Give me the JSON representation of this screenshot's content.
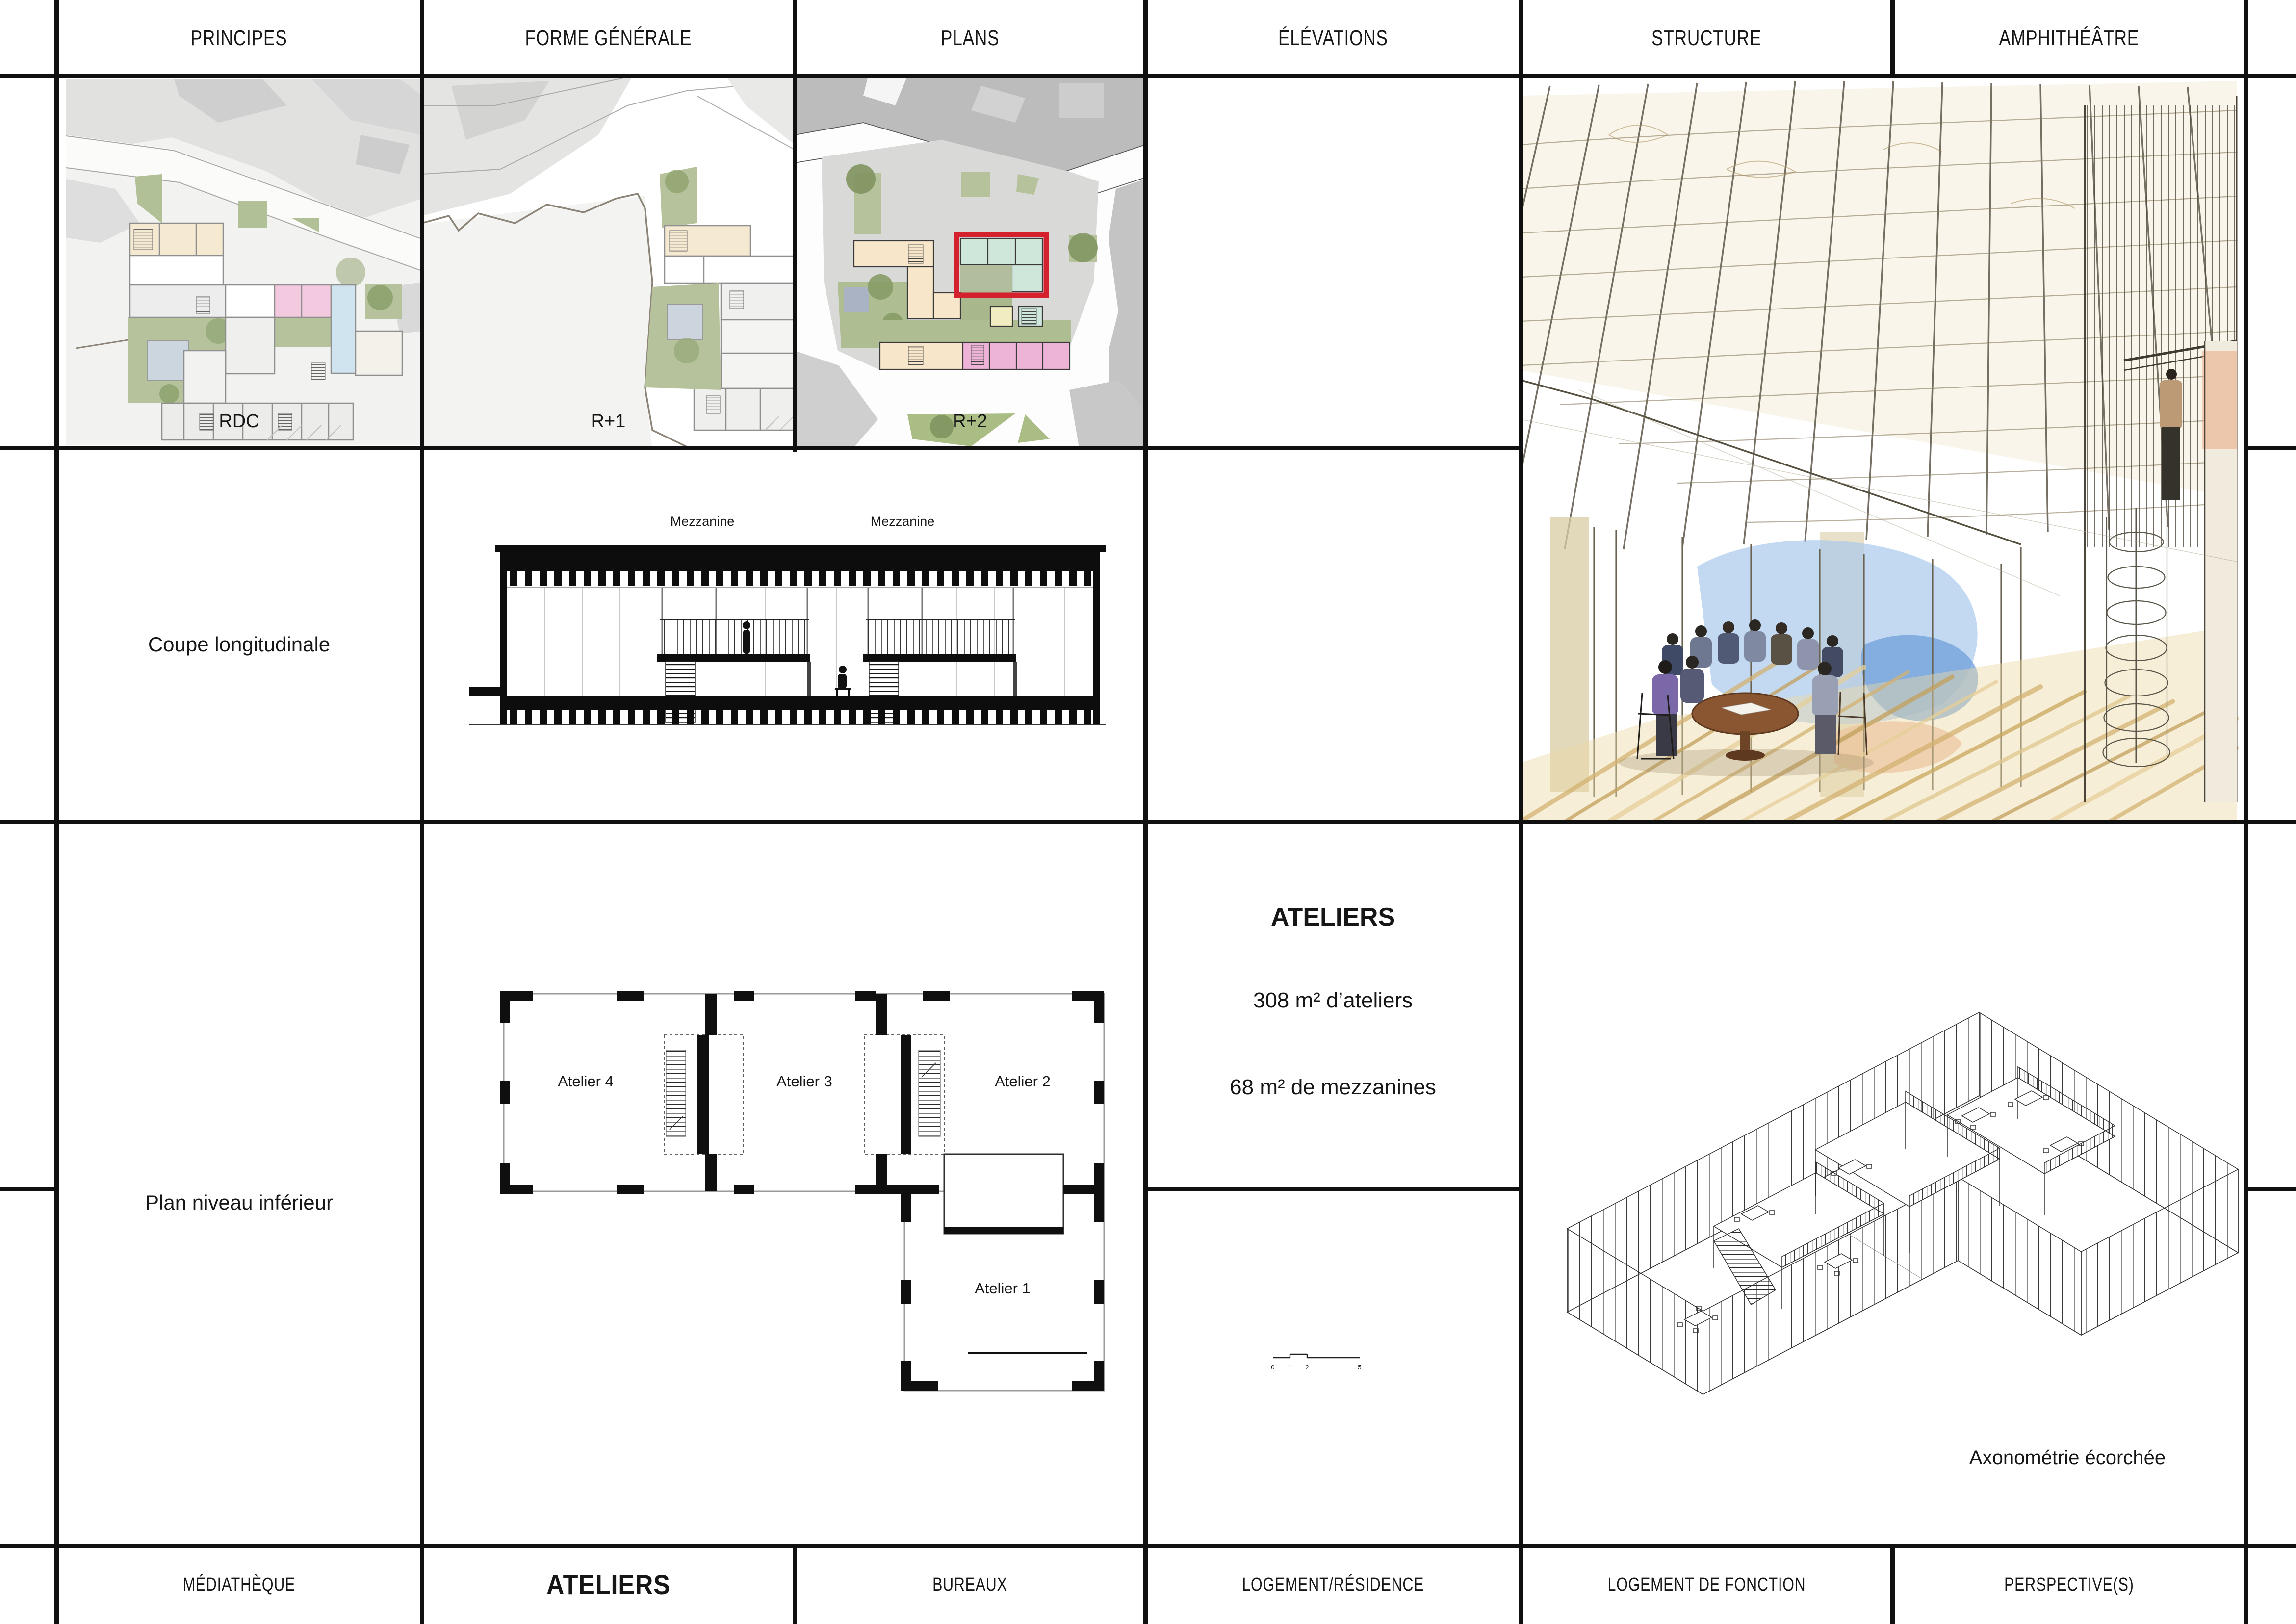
{
  "board": {
    "header": {
      "items": [
        "PRINCIPES",
        "FORME GÉNÉRALE",
        "PLANS",
        "ÉLÉVATIONS",
        "STRUCTURE",
        "AMPHITHÉÂTRE"
      ]
    },
    "footer": {
      "items": [
        "MÉDIATHÈQUE",
        "ATELIERS",
        "BUREAUX",
        "LOGEMENT/RÉSIDENCE",
        "LOGEMENT DE FONCTION",
        "PERSPECTIVE(S)"
      ],
      "active_item": "ATELIERS"
    },
    "row1": {
      "rdc_label": "RDC",
      "r1_label": "R+1",
      "r2_label": "R+2"
    },
    "row2": {
      "coupe_label": "Coupe longitudinale",
      "mezzanine_left": "Mezzanine",
      "mezzanine_right": "Mezzanine"
    },
    "row3": {
      "plan_label": "Plan niveau inférieur",
      "ateliers": {
        "title": "ATELIERS",
        "line1": "308 m² d’ateliers",
        "line2": "68 m² de mezzanines"
      },
      "rooms": [
        "Atelier 4",
        "Atelier 3",
        "Atelier 2",
        "Atelier 1"
      ],
      "axo_label": "Axonométrie écorchée",
      "scale_bar": {
        "ticks": [
          "0",
          "1",
          "2",
          "5"
        ]
      }
    },
    "colors": {
      "highlight_red": "#d5212e",
      "mint": "#cfe6da",
      "peach": "#f7e6c9",
      "pink": "#eeb4d8",
      "garden_green": "#b5c29b",
      "water_blue": "#cfe4ef",
      "yellow": "#f2edc0",
      "grid_black": "#101010"
    }
  }
}
